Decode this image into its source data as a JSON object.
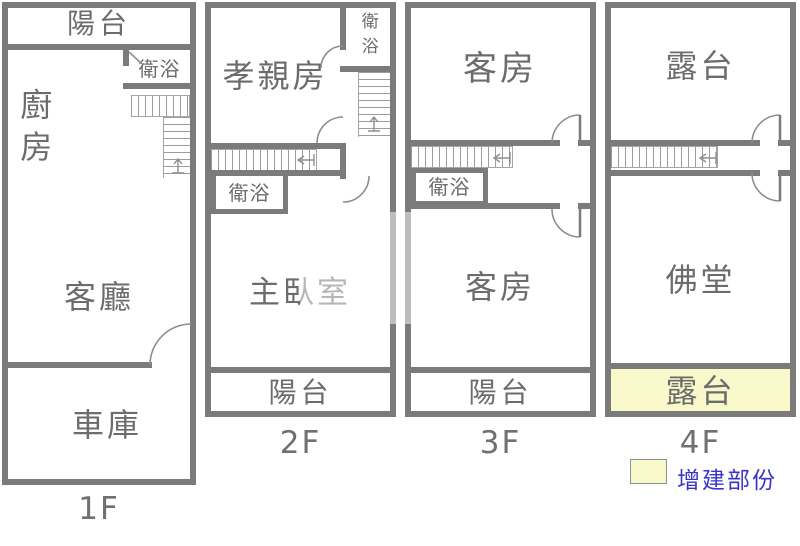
{
  "colors": {
    "wall_gray": "#7b7b7b",
    "room_text_gray": "#6c6c6c",
    "highlight_yellow": "#f8f8cb",
    "legend_text_blue": "#3a35c8"
  },
  "floors": [
    {
      "label": "1F",
      "rooms": {
        "balcony": "陽台",
        "bathroom": "衛浴",
        "kitchen": "廚房",
        "living_room": "客廳",
        "garage": "車庫"
      }
    },
    {
      "label": "2F",
      "rooms": {
        "bathroom_top": "衛浴",
        "parents_room": "孝親房",
        "bathroom": "衛浴",
        "master_bedroom": "主臥室",
        "balcony": "陽台"
      }
    },
    {
      "label": "3F",
      "rooms": {
        "guest_room_top": "客房",
        "bathroom": "衛浴",
        "guest_room": "客房",
        "balcony": "陽台"
      }
    },
    {
      "label": "4F",
      "rooms": {
        "terrace_top": "露台",
        "buddhist_hall": "佛堂",
        "terrace_bottom": "露台"
      }
    }
  ],
  "legend": {
    "label": "增建部份"
  }
}
